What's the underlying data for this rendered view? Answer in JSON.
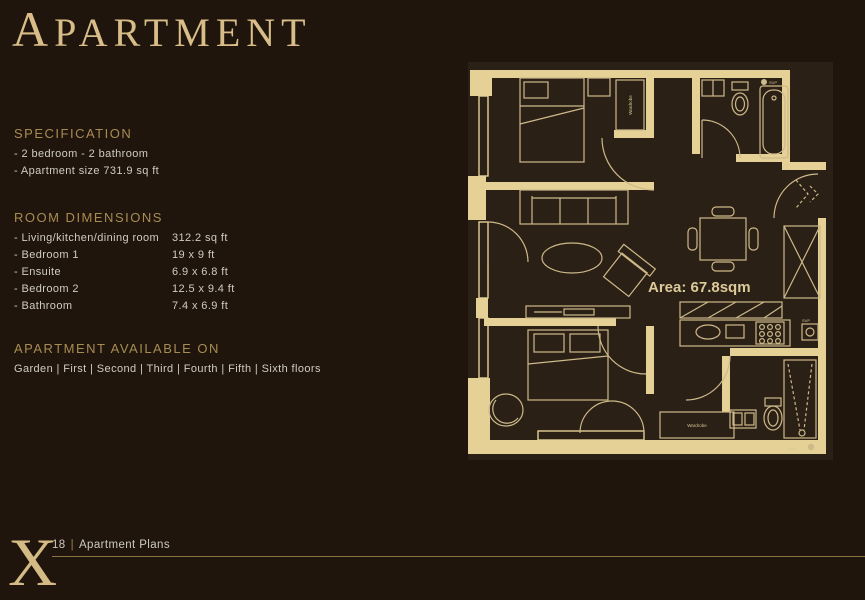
{
  "page": {
    "title": "APARTMENT"
  },
  "specification": {
    "heading": "SPECIFICATION",
    "items": [
      "- 2 bedroom - 2 bathroom",
      "- Apartment size 731.9 sq ft"
    ]
  },
  "room_dimensions": {
    "heading": "ROOM DIMENSIONS",
    "rows": [
      {
        "label": "- Living/kitchen/dining room",
        "value": "312.2 sq ft"
      },
      {
        "label": "- Bedroom 1",
        "value": "19 x 9 ft"
      },
      {
        "label": "- Ensuite",
        "value": "6.9 x 6.8 ft"
      },
      {
        "label": "- Bedroom 2",
        "value": "12.5 x 9.4 ft"
      },
      {
        "label": "- Bathroom",
        "value": "7.4 x 6.9 ft"
      }
    ]
  },
  "availability": {
    "heading": "APARTMENT AVAILABLE ON",
    "floors": "Garden | First | Second | Third | Fourth | Fifth | Sixth floors"
  },
  "floorplan": {
    "area_label": "Area: 67.8sqm",
    "wardrobe_label": "Wardrobe",
    "svp_label": "SVP"
  },
  "footer": {
    "ornament_letter": "X",
    "page_number": "18",
    "separator": "|",
    "section_title": "Apartment Plans"
  },
  "colors": {
    "background": "#20150c",
    "title_gold": "#d8bd88",
    "heading_gold": "#a78c52",
    "body_text": "#cfccc3",
    "plan_wall": "#e5d096",
    "plan_line": "#cdb98a",
    "footer_rule": "#8a7345"
  }
}
